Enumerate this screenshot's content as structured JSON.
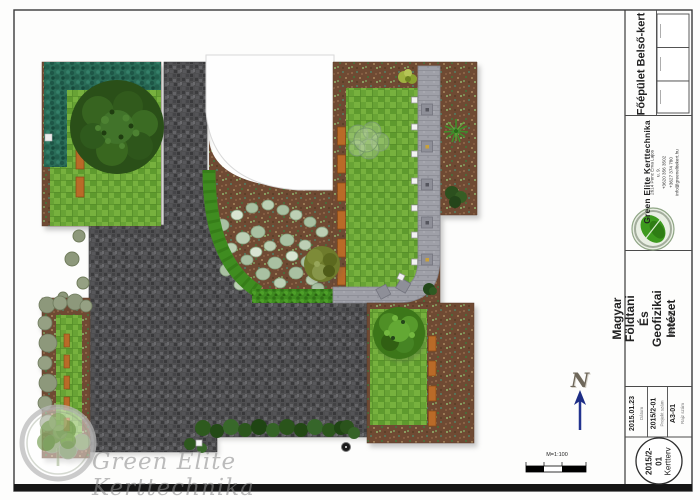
{
  "page": {
    "watermark": "Green Elite Kerttechnika",
    "scale_label": "M=1:100",
    "north_label": "N"
  },
  "title_block": {
    "drawing_title": "Főépület Belső-kert",
    "company": {
      "name": "Green Elite Kerttechnika",
      "address": "2614 Penc Erva Lajos u. 9.",
      "phone": "+3620 356 3502   +3627 374 780",
      "email": "info@greenelitekert.hu"
    },
    "project_title": "Magyar Földtani És Geofizikai Intézet",
    "project_subtitle": "Belső kert",
    "fields": [
      {
        "value": "2015.01.23",
        "label": "Dátum"
      },
      {
        "value": "2015/2-01",
        "label": "Projekt szám"
      },
      {
        "value": "A3-01",
        "label": "Rajz szám"
      }
    ],
    "stamp": {
      "line1": "2015/2-01",
      "line2": "Kertterv"
    }
  },
  "plan": {
    "features": [
      "cobblestone plaza",
      "lawns",
      "mulch planting beds",
      "groundcover bed",
      "hedges",
      "trees and shrubs",
      "benches",
      "walking path with stations",
      "building footprint",
      "north arrow",
      "scale bar"
    ],
    "colors": {
      "lawn": "#68a335",
      "cobblestone": "#4f4f51",
      "mulch": "#6f4a33",
      "bright_hedge": "#3f8c20",
      "teal_hedge": "#2a6d58",
      "path": "#9fa0a8",
      "bench": "#b96a28",
      "north_arrow_blue": "#22338f"
    }
  }
}
